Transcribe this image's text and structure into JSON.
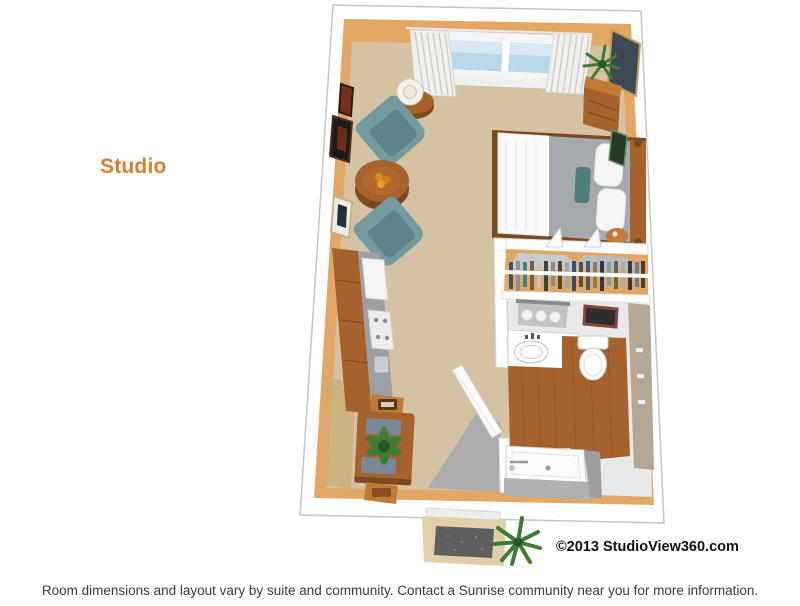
{
  "page": {
    "background": "#ffffff",
    "plan_label": "Studio",
    "copyright": "©2013 StudioView360.com",
    "footer": "Room dimensions and layout vary by suite and community. Contact a Sunrise community near you for more information."
  },
  "colors": {
    "label_orange": "#D97D2B",
    "footer_gray": "#3A3A3A",
    "copyright_black": "#111111",
    "wall_white": "#FEFEFE",
    "wall_edge": "#C6C6C6",
    "wall_tan": "#E2A765",
    "carpet": "#D5C2A3",
    "wood": "#A5622C",
    "wood_dark": "#7D4A20",
    "wood_light": "#C07A36",
    "teal_chair": "#74999F",
    "teal_chair_dark": "#5D838B",
    "glass_blue": "#B9D7EB",
    "blanket_gray": "#A6A9AD",
    "counter_gray": "#9BA0A5",
    "entry_tile_gray": "#ACACAC",
    "plant_green": "#3E7B33",
    "plant_green_dark": "#2A5526",
    "bath_wall_taupe": "#B5A795",
    "mat_gray": "#5F5F5F",
    "linen_white": "#FAFAFA",
    "accent_teal_pillow": "#4E7F7B",
    "floor_shadow_tan": "#C9AE77"
  },
  "floorplan": {
    "view": "3D bird's-eye rendering of a studio suite",
    "areas": [
      "living-sleeping area",
      "kitchenette",
      "dining nook",
      "closet",
      "bathroom",
      "entry"
    ],
    "furnishings": [
      "window with curtains",
      "two teal armchairs",
      "round coffee table",
      "side table with lamp",
      "wall art",
      "media chest with plant",
      "bed with pillows",
      "kitchenette counter with appliances",
      "dining table with plant and chairs",
      "closet rod with hanging clothes",
      "vanity with sink and three lights",
      "toilet",
      "tub-shower",
      "open entry and bathroom doors",
      "door mat",
      "potted plants"
    ]
  }
}
